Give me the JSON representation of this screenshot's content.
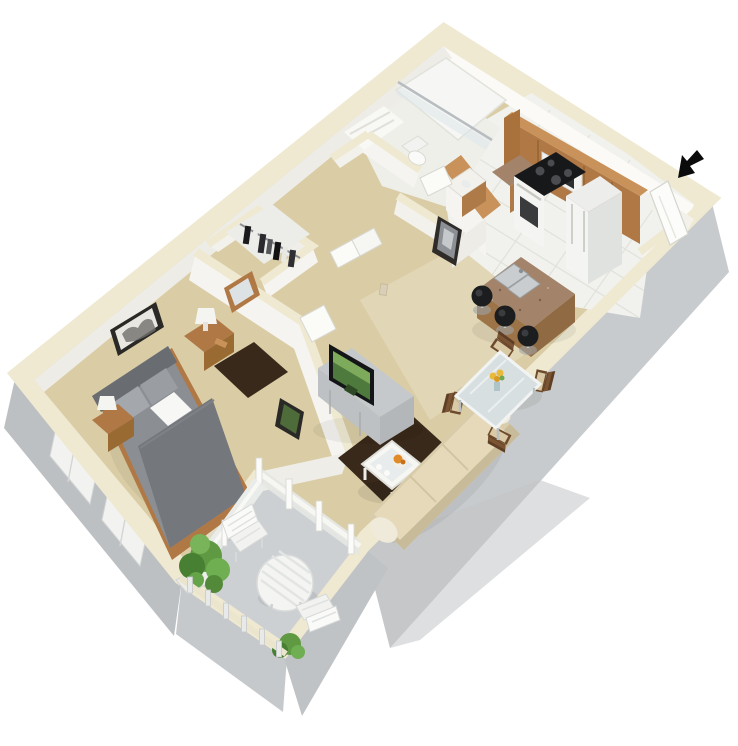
{
  "scene": {
    "label": "3D rendered one-bedroom apartment floor plan, isometric bird's-eye view on white background",
    "entry_marker": "black arrow pointing to open entry door at top right"
  },
  "rooms": [
    {
      "id": "bedroom",
      "name": "Bedroom"
    },
    {
      "id": "closet",
      "name": "Walk-in closet"
    },
    {
      "id": "bathroom",
      "name": "Bathroom"
    },
    {
      "id": "hallway",
      "name": "Hallway"
    },
    {
      "id": "kitchen",
      "name": "Kitchen"
    },
    {
      "id": "dining",
      "name": "Dining area"
    },
    {
      "id": "living",
      "name": "Living room"
    },
    {
      "id": "balcony",
      "name": "Balcony / patio"
    }
  ],
  "furniture": [
    {
      "id": "bed",
      "name": "queen bed with gray bedding"
    },
    {
      "id": "nightstands",
      "name": "two wood nightstands with lamps"
    },
    {
      "id": "bedroom-rug",
      "name": "dark brown bedroom rug"
    },
    {
      "id": "wall-art",
      "name": "framed wall art (bedroom, living, hallway)"
    },
    {
      "id": "mirror",
      "name": "wood framed mirror"
    },
    {
      "id": "closet-clothes",
      "name": "hanging clothes on rod"
    },
    {
      "id": "tv-stand",
      "name": "gray media console with flat-screen TV"
    },
    {
      "id": "coffee-table",
      "name": "white glass-top coffee table with snacks"
    },
    {
      "id": "living-rug",
      "name": "dark brown living room rug"
    },
    {
      "id": "sofa",
      "name": "tan sofa"
    },
    {
      "id": "dining-table",
      "name": "glass dining table with flowers and four chairs"
    },
    {
      "id": "island",
      "name": "granite kitchen island with double sink"
    },
    {
      "id": "barstools",
      "name": "three black bar stools"
    },
    {
      "id": "range",
      "name": "white range with black cooktop and microwave"
    },
    {
      "id": "refrigerator",
      "name": "white refrigerator"
    },
    {
      "id": "cabinets",
      "name": "oak upper and lower cabinets"
    },
    {
      "id": "shower",
      "name": "glass shower / tub"
    },
    {
      "id": "toilet",
      "name": "toilet"
    },
    {
      "id": "vanity",
      "name": "bathroom vanity"
    },
    {
      "id": "patio-set",
      "name": "white round patio table with two slatted chairs"
    },
    {
      "id": "shrubs",
      "name": "green shrubs in planters"
    },
    {
      "id": "railing",
      "name": "balcony railing posts"
    },
    {
      "id": "entry-door",
      "name": "open white entry door"
    }
  ],
  "colors": {
    "bg": "#ffffff",
    "wallTop": "#EFE9D2",
    "wallFace": "#F5F4F0",
    "wallShade": "#E7E6E1",
    "exteriorGray": "#C8CBCD",
    "exteriorGrayDark": "#BDC0C2",
    "carpet": "#DACDA6",
    "carpetLight": "#E4DABC",
    "tile": "#F1F1ED",
    "grout": "#E2E2DC",
    "balconyFloor": "#CDD0D2",
    "rugDark": "#38291A",
    "wood": "#B07845",
    "woodLight": "#C8925A",
    "woodDark": "#9A6A33",
    "granite": "#A3846A",
    "graniteDark": "#8F6A42",
    "bedGray": "#8B8E93",
    "bedGrayDark": "#74777C",
    "headboard": "#696C71",
    "pillowGray": "#A4A7AC",
    "linen": "#F7F8F6",
    "couch": "#D9CCAB",
    "cushion": "#E5D9BA",
    "sofaArm": "#F0EADA",
    "tvBlack": "#131517",
    "screen": "#4E7A3D",
    "screenLight": "#8AB763",
    "artGreen": "#4E6B3A",
    "glass": "#D8DFE1",
    "chairBrown": "#6E4A2C",
    "seatTan": "#D9C9A4",
    "stoolBlack": "#1C1D1F",
    "chrome": "#BFC4C7",
    "appliance": "#F4F4F2",
    "cooktop": "#17181A",
    "steel": "#C9CDCF",
    "plant": "#5F9A43",
    "plantDark": "#477F33",
    "arrowBlack": "#0B0B0B",
    "flower": "#E8B93A",
    "foodOrange": "#E08A28"
  }
}
